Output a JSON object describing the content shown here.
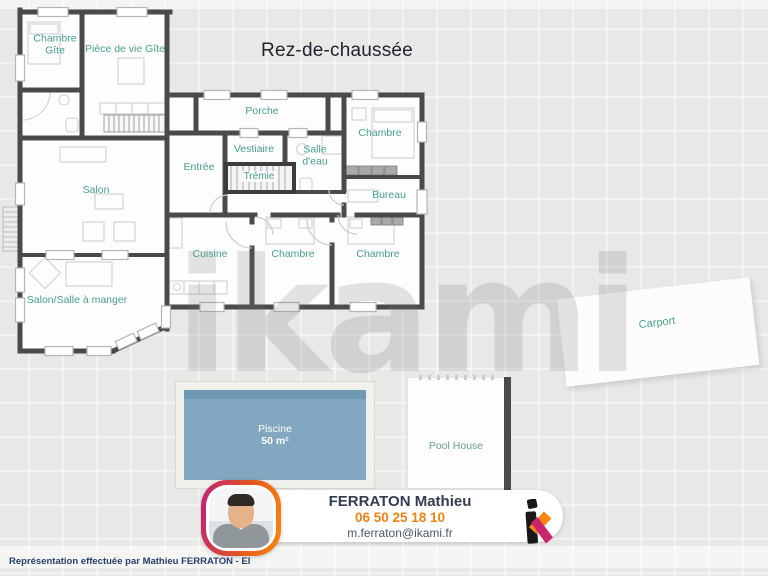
{
  "title": "Rez-de-chaussée",
  "watermark_text": "ikami",
  "rooms": {
    "chambre_gite": "Chambre Gîte",
    "piece_de_vie_gite": "Pièce de vie Gîte",
    "porche": "Porche",
    "entree": "Entrée",
    "vestiaire": "Vestiaire",
    "salle_eau": "Salle d'eau",
    "tremie": "Trémie",
    "chambre_nord": "Chambre",
    "bureau": "Bureau",
    "salon": "Salon",
    "cuisine": "Cuisine",
    "chambre_centre": "Chambre",
    "chambre_est": "Chambre",
    "salon_salle_a_manger": "Salon/Salle à manger"
  },
  "outdoor": {
    "carport": "Carport",
    "pool": {
      "name": "Piscine",
      "area": "50 m²"
    },
    "pool_house": "Pool House"
  },
  "agent_card": {
    "name": "FERRATON Mathieu",
    "phone": "06 50 25 18 10",
    "email": "m.ferraton@ikami.fr",
    "logo": "ikami-k-logo"
  },
  "footer": "Représentation effectuée par Mathieu FERRATON - EI",
  "colors": {
    "label_teal": "#4a9e8d",
    "wall_gray": "#4a4a4a",
    "pool_water": "#82a7c0",
    "accent_orange": "#f8870e",
    "accent_magenta": "#bf2077",
    "name_navy": "#333d52",
    "background": "#e8e8e6"
  }
}
